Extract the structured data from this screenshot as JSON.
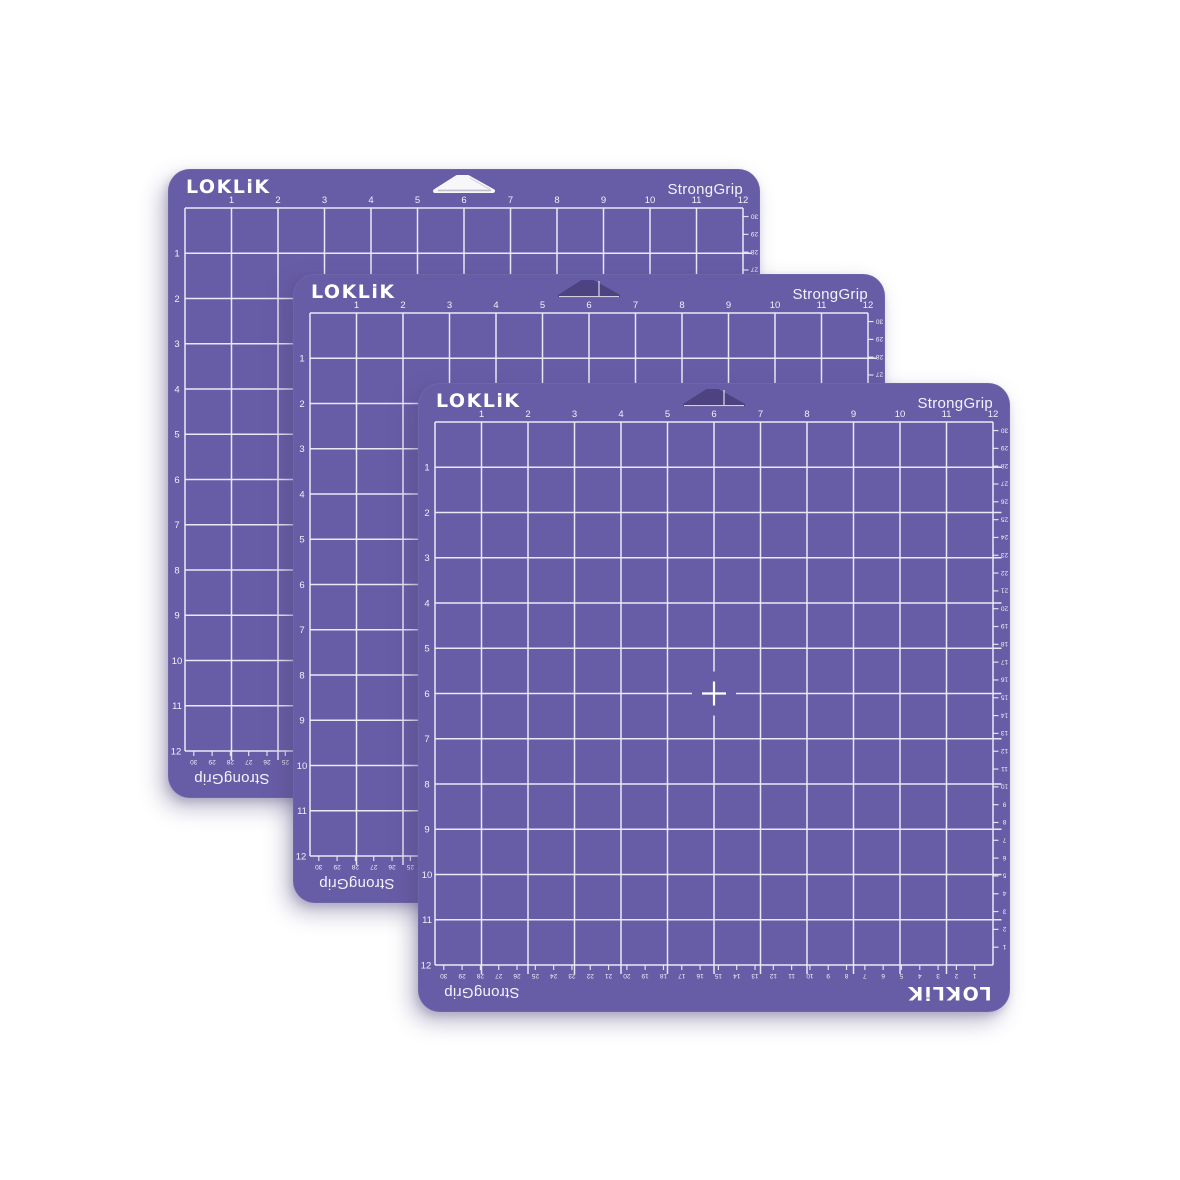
{
  "scene": {
    "description": "Three purple StrongGrip 12x12 inch cutting mats fanned diagonally on a white background",
    "background_color": "#ffffff",
    "mat_count": 3
  },
  "colors": {
    "mat": "#675CA6",
    "grid_line": "#EBE8F5",
    "label_text": "#F2F0FA",
    "logo_text": "#FFFFFF",
    "notch_hole": "#4E4381",
    "notch_back_hole": "#F7F6F9",
    "notch_back_shade": "#BDB9C9",
    "shadow": "rgba(88,78,130,0.38)"
  },
  "mat": {
    "brand_logo": "LOKLiK",
    "grip_label": "StrongGrip",
    "bottom_brand_logo": "LOKLiK",
    "bottom_grip_label": "StrongGrip",
    "bottom_left_corner_label": "12",
    "top_inch_labels": [
      "1",
      "2",
      "3",
      "4",
      "5",
      "6",
      "7",
      "8",
      "9",
      "10",
      "11",
      "12"
    ],
    "left_inch_labels": [
      "1",
      "2",
      "3",
      "4",
      "5",
      "6",
      "7",
      "8",
      "9",
      "10",
      "11"
    ],
    "right_cm_labels": [
      "30",
      "29",
      "28",
      "27",
      "26",
      "25",
      "24",
      "23",
      "22",
      "21",
      "20",
      "19",
      "18",
      "17",
      "16",
      "15",
      "14",
      "13",
      "12",
      "11",
      "10",
      "9",
      "8",
      "7",
      "6",
      "5",
      "4",
      "3",
      "2",
      "1"
    ],
    "bottom_cm_labels": [
      "30",
      "29",
      "28",
      "27",
      "26",
      "25",
      "24",
      "23",
      "22",
      "21",
      "20",
      "19",
      "18",
      "17",
      "16",
      "15",
      "14",
      "13",
      "12",
      "11",
      "10",
      "9",
      "8",
      "7",
      "6",
      "5",
      "4",
      "3",
      "2",
      "1"
    ],
    "grid": {
      "columns": 12,
      "rows": 12,
      "center_marker": "cross"
    }
  },
  "mats": [
    {
      "id": "back-mat",
      "notch_style": "background"
    },
    {
      "id": "middle-mat",
      "notch_style": "hole"
    },
    {
      "id": "front-mat",
      "notch_style": "hole"
    }
  ]
}
